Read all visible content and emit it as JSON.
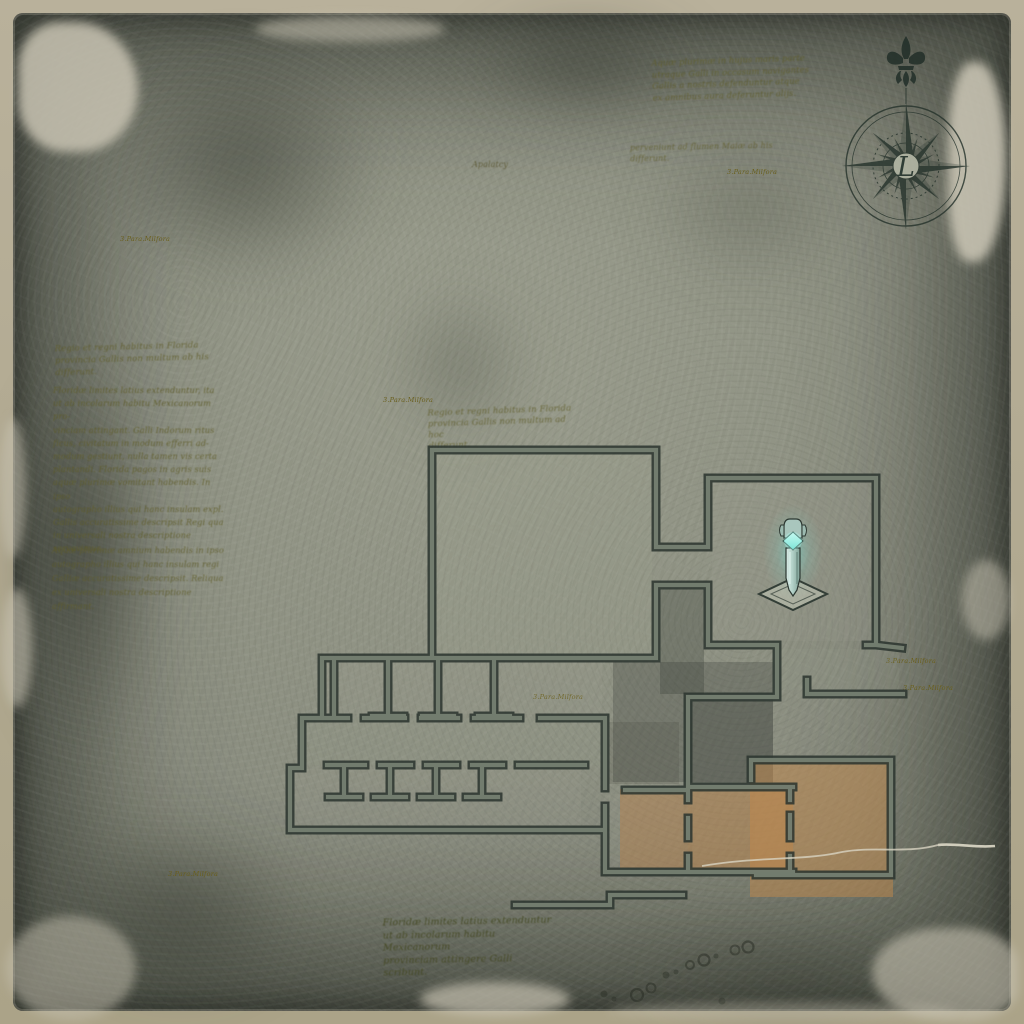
{
  "annotations": {
    "top_block": "Aquæ plurimæ in hujus maris parte\nutraque Galli in occasum navigantes\nGallis a nostris defenduntur atque\nex amnibus aura deferuntur alijs.",
    "top_fragment": "perveniunt ad flumen Maiæ ab his\ndifferunt.",
    "region_label": "Apalatcy",
    "left_p1": "Regio et regni habitus in Florida\nprovincia Gallis non multum ab his\ndifferunt.",
    "left_p2": "Floridæ limites latius extenduntur, ita\nut ab incolarum habitu Mexicanorum pro-\nvinciam attingant. Galli Indorum ritus\nficus, civitatum in modum efferri ad-\nmodum gestiunt, nulla tamen vis certa\nplantandi. Florida pagos in agris suis\naquæ plurimæ vomitant habendis. In ipso\nautographo illius qui hanc insulam expl.\nGallis accuratissime descripsit Regi qua\nin universali nostra descriptione servavimus.",
    "left_p3": "Aquæ plurimæ amnium habendis in ipso\nautographo illius qui hanc insulam regi\nGalliæ accuratissime descripsit. Reliqua\nex universali nostra descriptione affirmant.",
    "mid_block": "Regio et regni habitus in Florida\nprovincia Gallis non multum ad hoc\ndifferunt.",
    "bottom_block": "Floridæ limites latius extenduntur\nut ab incolarum habitu Mexicanorum\nprovinciam attingere Galli scribunt.",
    "marker_label": "3.Para.Milfora"
  },
  "compass": {
    "center_letter": "L"
  },
  "icons": {
    "compass_rose": "compass-rose",
    "fleur_de_lis": "fleur-de-lis",
    "obelisk_marker": "glowing-obelisk-waypoint",
    "ink_dots": "ink-dot-trail"
  },
  "colors": {
    "frame": "#b3ab95",
    "parchment": "#8e9181",
    "wall": "#2c3630",
    "wall_inner": "#798374",
    "highlight": "#c08040",
    "obelisk_glow": "#7ce0d4",
    "ink": "#5f5c28",
    "ink_dark": "#42461e",
    "label_ink": "#6a5f1c"
  }
}
